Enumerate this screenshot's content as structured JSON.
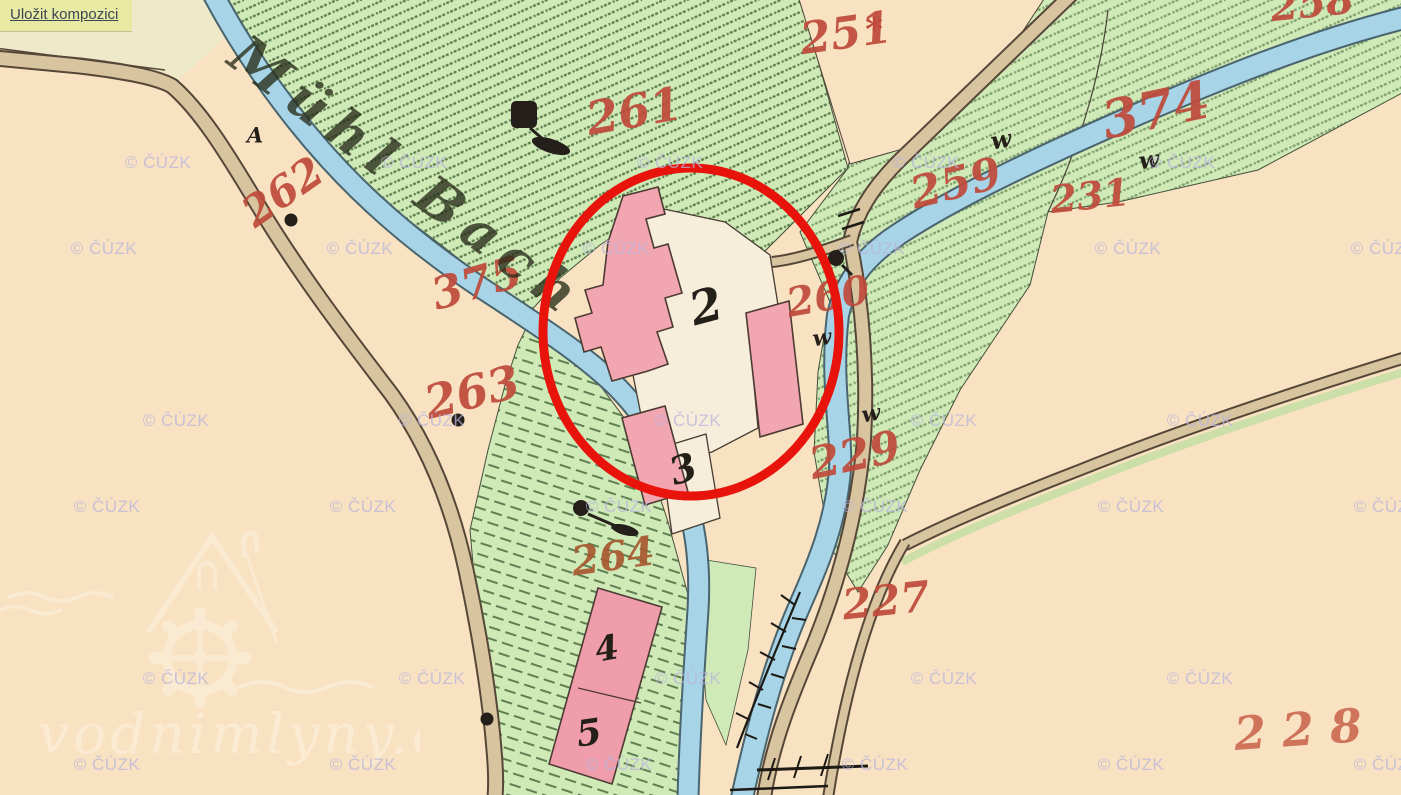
{
  "colors": {
    "paper": "#f8e2c1",
    "green": "#cfe9b7",
    "stream": "#a7d4e6",
    "stream_edge": "#4a656f",
    "road": "#d8c5a0",
    "road_edge": "#564738",
    "building": "#f2a6b0",
    "building_edge": "#4d3b33",
    "white_parcel": "#f6eedb",
    "number_red": "#bf4a3a",
    "number_black": "#241f19",
    "circle_red": "#e8130a",
    "button_bg": "#e8e9a2",
    "button_text": "#3c4754"
  },
  "toolbar": {
    "save_label": "Uložit kompozici"
  },
  "map": {
    "stream_label": "Mühl Bach",
    "copyright": "© ČÚZK",
    "watermark_site": "vodnimlyny.cz",
    "parcel_numbers": [
      {
        "text": "251",
        "x": 846,
        "y": 34,
        "rot": -8,
        "size": 44
      },
      {
        "text": "261",
        "x": 634,
        "y": 111,
        "rot": -10,
        "size": 46
      },
      {
        "text": "258",
        "x": 1312,
        "y": 4,
        "rot": -6,
        "size": 40
      },
      {
        "text": "374",
        "x": 1156,
        "y": 111,
        "rot": -12,
        "size": 52
      },
      {
        "text": "259",
        "x": 956,
        "y": 184,
        "rot": -14,
        "size": 44
      },
      {
        "text": "231",
        "x": 1090,
        "y": 196,
        "rot": -6,
        "size": 38
      },
      {
        "text": "262",
        "x": 283,
        "y": 192,
        "rot": -35,
        "size": 42
      },
      {
        "text": "375",
        "x": 477,
        "y": 284,
        "rot": -16,
        "size": 44
      },
      {
        "text": "263",
        "x": 472,
        "y": 392,
        "rot": -14,
        "size": 46
      },
      {
        "text": "260",
        "x": 828,
        "y": 297,
        "rot": -10,
        "size": 40
      },
      {
        "text": "229",
        "x": 855,
        "y": 456,
        "rot": -12,
        "size": 44
      },
      {
        "text": "227",
        "x": 886,
        "y": 601,
        "rot": -6,
        "size": 42
      },
      {
        "text": "264",
        "x": 613,
        "y": 557,
        "rot": -8,
        "size": 40,
        "color": "#a8582f"
      },
      {
        "text": "228",
        "x": 1306,
        "y": 729,
        "rot": -4,
        "size": 46,
        "spacing": 16,
        "color": "#cc6a52"
      }
    ],
    "house_numbers": [
      {
        "text": "2",
        "x": 706,
        "y": 306,
        "rot": -15,
        "size": 46
      },
      {
        "text": "3",
        "x": 683,
        "y": 469,
        "rot": -18,
        "size": 38
      },
      {
        "text": "4",
        "x": 607,
        "y": 649,
        "rot": -10,
        "size": 34
      },
      {
        "text": "5",
        "x": 589,
        "y": 733,
        "rot": -8,
        "size": 36
      }
    ],
    "w_symbols": [
      {
        "text": "w",
        "x": 1001,
        "y": 140,
        "rot": -10,
        "size": 24
      },
      {
        "text": "w",
        "x": 1149,
        "y": 160,
        "rot": -8,
        "size": 24
      },
      {
        "text": "w",
        "x": 822,
        "y": 338,
        "rot": -8,
        "size": 22
      },
      {
        "text": "w",
        "x": 871,
        "y": 414,
        "rot": -10,
        "size": 22
      }
    ],
    "misc_symbols": [
      {
        "text": "A",
        "x": 255,
        "y": 135,
        "rot": 0,
        "size": 21
      },
      {
        "text": "*",
        "x": 874,
        "y": 30,
        "rot": 0,
        "size": 34,
        "color": "#bf4a3a"
      }
    ],
    "cuzk_watermarks": [
      {
        "x": 158,
        "y": 163
      },
      {
        "x": 414,
        "y": 163
      },
      {
        "x": 670,
        "y": 163
      },
      {
        "x": 926,
        "y": 163
      },
      {
        "x": 1182,
        "y": 163
      },
      {
        "x": 104,
        "y": 249
      },
      {
        "x": 360,
        "y": 249
      },
      {
        "x": 616,
        "y": 249
      },
      {
        "x": 872,
        "y": 249
      },
      {
        "x": 1128,
        "y": 249
      },
      {
        "x": 1384,
        "y": 249
      },
      {
        "x": 176,
        "y": 421
      },
      {
        "x": 432,
        "y": 421
      },
      {
        "x": 688,
        "y": 421
      },
      {
        "x": 944,
        "y": 421
      },
      {
        "x": 1200,
        "y": 421
      },
      {
        "x": 107,
        "y": 507
      },
      {
        "x": 363,
        "y": 507
      },
      {
        "x": 619,
        "y": 507
      },
      {
        "x": 875,
        "y": 507
      },
      {
        "x": 1131,
        "y": 507
      },
      {
        "x": 1387,
        "y": 507
      },
      {
        "x": 176,
        "y": 679
      },
      {
        "x": 432,
        "y": 679
      },
      {
        "x": 688,
        "y": 679
      },
      {
        "x": 944,
        "y": 679
      },
      {
        "x": 1200,
        "y": 679
      },
      {
        "x": 107,
        "y": 765
      },
      {
        "x": 363,
        "y": 765
      },
      {
        "x": 619,
        "y": 765
      },
      {
        "x": 875,
        "y": 765
      },
      {
        "x": 1131,
        "y": 765
      },
      {
        "x": 1387,
        "y": 765
      }
    ]
  }
}
